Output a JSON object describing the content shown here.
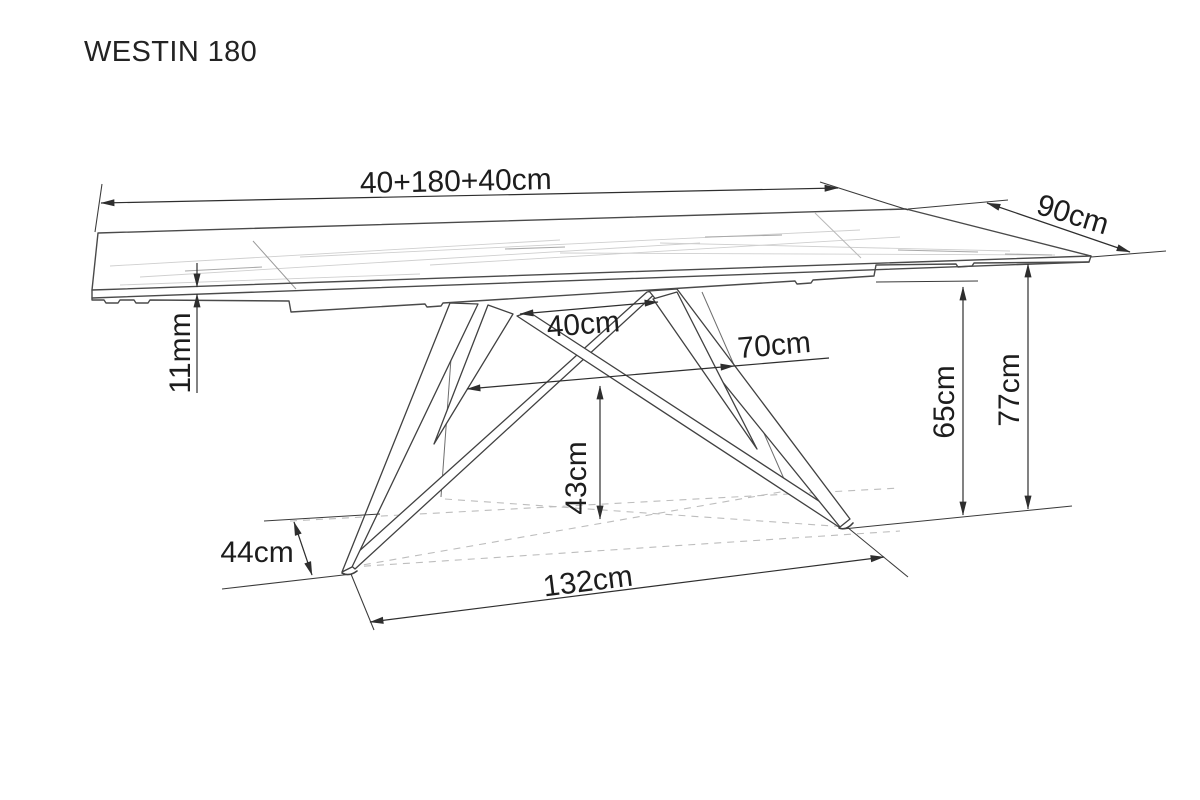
{
  "title": "WESTIN 180",
  "labels": {
    "total_length": "40+180+40cm",
    "depth": "90cm",
    "top_thickness": "11mm",
    "base_top_span": "40cm",
    "base_mid_span": "70cm",
    "clearance_height": "43cm",
    "frame_height": "65cm",
    "table_height": "77cm",
    "foot_width": "44cm",
    "base_length": "132cm"
  },
  "drawing": {
    "type": "technical-dimension-drawing",
    "subject": "extendable dining table, perspective view",
    "line_color": "#414141",
    "text_color": "#1d1d1d",
    "background": "#ffffff"
  }
}
